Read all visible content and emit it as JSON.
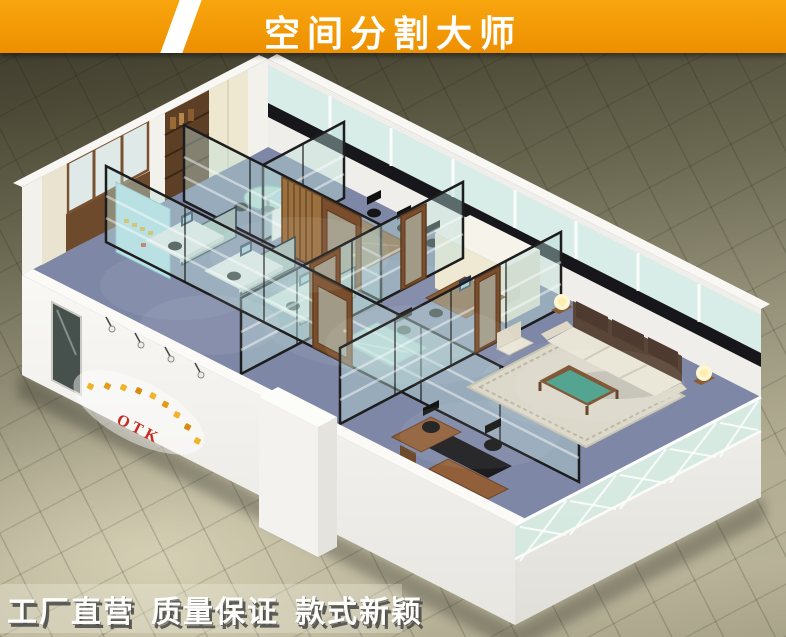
{
  "banner": {
    "title": "空间分割大师",
    "background_color": "#f39800",
    "text_color": "#ffffff",
    "slash_color": "#ffffff"
  },
  "office": {
    "logo_text": "OTK",
    "description": "3D isometric render of an office interior divided by black-framed glass partition walls",
    "areas": [
      "reception corridor",
      "open-plan workstations",
      "round glass meeting table",
      "conference room",
      "glass manager office",
      "computer desk office",
      "executive lounge with sofa set",
      "executive desk office"
    ],
    "colors": {
      "carpet": "#7e87a6",
      "glass_partition": "#cfe6e1",
      "partition_frame": "#1d1d1d",
      "wood": "#7a4e2c",
      "outer_wall": "#f4f3ef",
      "sofa": "#e9e5d6",
      "coffee_table_glass": "#49a08c",
      "logo_red": "#c62b22",
      "logo_yellow": "#f0b42a"
    }
  },
  "footer": {
    "slogans": [
      "工厂直营",
      "质量保证",
      "款式新颖"
    ],
    "text_color": "#ffffff"
  }
}
